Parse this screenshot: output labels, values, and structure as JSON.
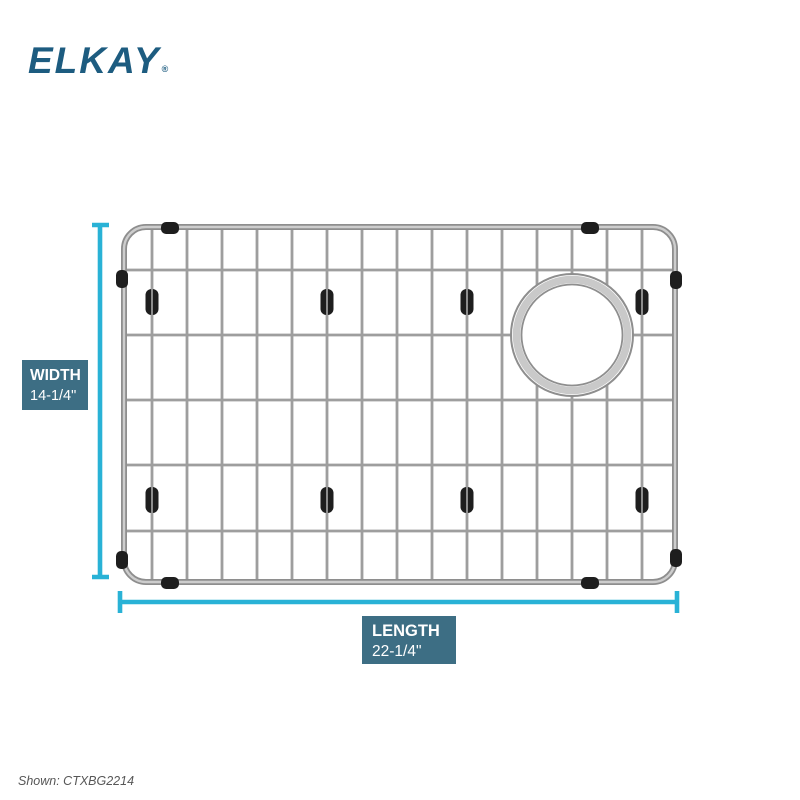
{
  "brand": {
    "logo_text": "ELKAY",
    "registered_mark": "®"
  },
  "dimensions": {
    "width": {
      "label": "WIDTH",
      "value": "14-1/4\""
    },
    "length": {
      "label": "LENGTH",
      "value": "22-1/4\""
    }
  },
  "product": {
    "shown_label": "Shown: CTXBG2214"
  },
  "colors": {
    "accent": "#29b2d6",
    "label-bg": "#3d6e84",
    "label-text": "#ffffff",
    "brand-blue": "#1d5c80",
    "steel": "#9e9e9e",
    "steel-dark": "#8e8e8e",
    "steel-light": "#cdcdcd",
    "clip-black": "#1e1e1e",
    "caption-gray": "#575757"
  }
}
